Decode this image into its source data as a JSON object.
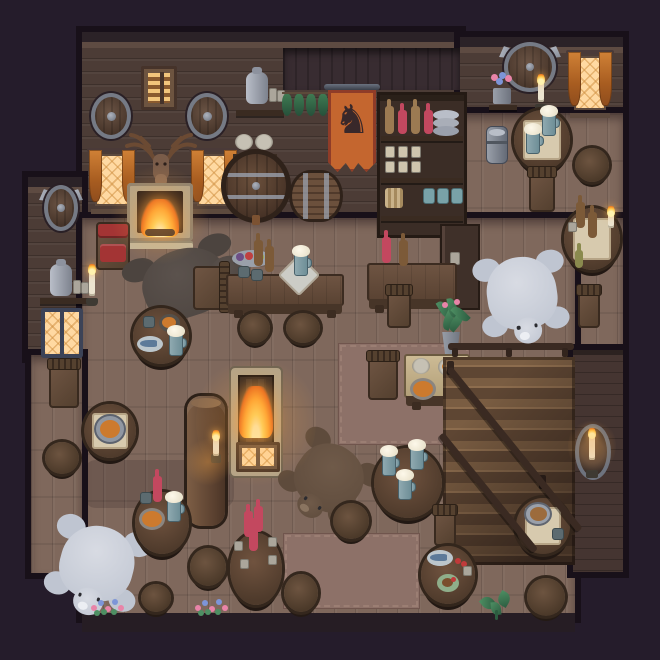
{
  "meta": {
    "app": "Pixel-art tavern interior — top-down game scene",
    "canvas": {
      "w": 660,
      "h": 660
    }
  },
  "palette": {
    "outside": "#251c2b",
    "frame": "#181019",
    "wallBase": "#4c3c36",
    "wallHeader": "#2b2227",
    "wallTrim": "#5e4b42",
    "wallRecess": "#382c31",
    "wallLow": "#453531",
    "floorBase": "#7f685c",
    "band": "#261d24",
    "carpet": "#8d7168",
    "carpetBorder": "#a3867a",
    "stone": "#b3a489",
    "cloth": "#d7caae",
    "windowGlow": "#ffd9a2",
    "fire1": "#ffe08a",
    "fire2": "#ffae34",
    "fire3": "#e25c1e",
    "bottleRed": "#c3485f",
    "bottleBrown": "#7c5a38",
    "bottleTan": "#9c7a52",
    "mugTeal": "#7fa0a8",
    "foam": "#f3ecd9",
    "polar": "#d8dbe3",
    "polarShade": "#bfc5d1",
    "rugBrown": "#6f5a49",
    "rugDark": "#5b524d",
    "plant": "#3c7a55",
    "flowerPink": "#e884a8",
    "flowerBlue": "#7d95d8",
    "soup": "#cc7a2e",
    "cushion": "#a33434",
    "banner": "#c4662f",
    "bannerTrim": "#8f3c28",
    "horse": "#39282a",
    "metal": "#9aa0ac"
  },
  "structure": [
    {
      "n": "wall-main",
      "k": "wall",
      "x": 82,
      "y": 32,
      "w": 378,
      "h": 188
    },
    {
      "n": "wall-right",
      "k": "wall",
      "x": 460,
      "y": 37,
      "w": 163,
      "h": 78
    },
    {
      "n": "wall-annex-left",
      "k": "wall",
      "x": 28,
      "y": 177,
      "w": 54,
      "h": 180
    },
    {
      "n": "wall-recess-center",
      "k": "wall-recess",
      "x": 283,
      "y": 48,
      "w": 177,
      "h": 42
    },
    {
      "n": "floor-right-upper",
      "k": "floor",
      "x": 460,
      "y": 113,
      "w": 163,
      "h": 107
    },
    {
      "n": "floor-right-mid",
      "k": "floor",
      "x": 575,
      "y": 218,
      "w": 48,
      "h": 132
    },
    {
      "n": "floor-main",
      "k": "floor",
      "x": 82,
      "y": 218,
      "w": 493,
      "h": 399
    },
    {
      "n": "floor-annex-left",
      "k": "floor",
      "x": 31,
      "y": 355,
      "w": 51,
      "h": 218
    },
    {
      "n": "wall-stairwell-right",
      "k": "wall-low",
      "x": 573,
      "y": 350,
      "w": 50,
      "h": 222
    },
    {
      "n": "baseboard-bottom",
      "k": "band",
      "x": 82,
      "y": 613,
      "w": 493,
      "h": 19
    },
    {
      "n": "carpet-center",
      "k": "carpet",
      "x": 338,
      "y": 343,
      "w": 132,
      "h": 102
    },
    {
      "n": "carpet-bottom",
      "k": "carpet",
      "x": 283,
      "y": 533,
      "w": 137,
      "h": 76
    },
    {
      "n": "floor-shadow-left",
      "k": "shadow",
      "x": 84,
      "y": 460,
      "w": 150,
      "h": 48
    }
  ],
  "objects": [
    {
      "n": "shuttered-window",
      "k": "win-shutter",
      "x": 141,
      "y": 66,
      "w": 36,
      "h": 44,
      "i": false
    },
    {
      "n": "round-shield-left",
      "k": "shield",
      "x": 91,
      "y": 93,
      "w": 40,
      "h": 46,
      "i": false
    },
    {
      "n": "round-shield-right",
      "k": "shield",
      "x": 187,
      "y": 93,
      "w": 40,
      "h": 46,
      "i": false
    },
    {
      "n": "stag-trophy",
      "k": "stag",
      "x": 121,
      "y": 130,
      "w": 80,
      "h": 62,
      "i": false
    },
    {
      "n": "curtain-window-left",
      "k": "win-curtain",
      "x": 87,
      "y": 148,
      "w": 50,
      "h": 66,
      "i": false
    },
    {
      "n": "curtain-window-right",
      "k": "win-curtain",
      "x": 189,
      "y": 148,
      "w": 50,
      "h": 66,
      "i": false
    },
    {
      "n": "stone-fireplace",
      "k": "fireplace",
      "x": 127,
      "y": 183,
      "w": 66,
      "h": 66,
      "i": true
    },
    {
      "n": "jug-shelf-center",
      "k": "jugshelf",
      "x": 236,
      "y": 70,
      "w": 48,
      "h": 46,
      "i": false
    },
    {
      "n": "hanging-herbs",
      "k": "herbs",
      "x": 282,
      "y": 92,
      "w": 48,
      "h": 30,
      "i": false
    },
    {
      "n": "horse-banner",
      "k": "banner",
      "x": 324,
      "y": 84,
      "w": 56,
      "h": 88,
      "i": false
    },
    {
      "n": "plate-shelf",
      "k": "plateshelf",
      "x": 233,
      "y": 134,
      "w": 44,
      "h": 26,
      "i": false
    },
    {
      "n": "basket-shelf",
      "k": "basketshelf",
      "x": 232,
      "y": 170,
      "w": 50,
      "h": 40,
      "i": false
    },
    {
      "n": "barrel-front",
      "k": "barrel-face",
      "x": 221,
      "y": 149,
      "w": 70,
      "h": 74,
      "i": true
    },
    {
      "n": "barrel-side",
      "k": "barrel-side",
      "x": 289,
      "y": 170,
      "w": 54,
      "h": 52,
      "i": true
    },
    {
      "n": "bottle-shelf-unit",
      "k": "shelfunit",
      "x": 377,
      "y": 92,
      "w": 90,
      "h": 146,
      "i": true,
      "p": {
        "top": [
          "tan",
          "red",
          "tan",
          "red"
        ],
        "cups": 6,
        "tealMugs": 3
      }
    },
    {
      "n": "side-counter",
      "k": "counter",
      "x": 440,
      "y": 224,
      "w": 40,
      "h": 86,
      "i": true
    },
    {
      "n": "axe-shield-large",
      "k": "shield-axe",
      "x": 498,
      "y": 40,
      "w": 64,
      "h": 54,
      "i": false
    },
    {
      "n": "flower-pot-shelf",
      "k": "flowershelf",
      "x": 489,
      "y": 72,
      "w": 28,
      "h": 38,
      "i": false
    },
    {
      "n": "candle-sconce-upper",
      "k": "sconce",
      "x": 533,
      "y": 76,
      "w": 16,
      "h": 36,
      "i": false
    },
    {
      "n": "curtain-window-upper-right",
      "k": "win-curtain",
      "x": 566,
      "y": 50,
      "w": 48,
      "h": 68,
      "i": false
    },
    {
      "n": "axe-shield-annex",
      "k": "shield-axe",
      "x": 38,
      "y": 183,
      "w": 46,
      "h": 50,
      "i": false
    },
    {
      "n": "jug-shelf-annex",
      "k": "jugshelf",
      "x": 40,
      "y": 262,
      "w": 50,
      "h": 42,
      "i": false
    },
    {
      "n": "candle-sconce-annex",
      "k": "sconce",
      "x": 84,
      "y": 266,
      "w": 16,
      "h": 40,
      "i": false
    },
    {
      "n": "side-window-annex",
      "k": "win-side",
      "x": 41,
      "y": 308,
      "w": 42,
      "h": 50,
      "i": false
    },
    {
      "n": "cushioned-chair",
      "k": "chair-red",
      "x": 94,
      "y": 220,
      "w": 38,
      "h": 52,
      "i": true
    },
    {
      "n": "rug-darkbear",
      "k": "rug-bear",
      "x": 128,
      "y": 240,
      "w": 114,
      "h": 88,
      "i": false,
      "p": {
        "tone": "dark",
        "rot": -18,
        "head": "right"
      }
    },
    {
      "n": "chair-by-rug",
      "k": "chair",
      "x": 190,
      "y": 260,
      "w": 40,
      "h": 54,
      "i": true,
      "p": {
        "dir": "right"
      }
    },
    {
      "n": "table-fish-west",
      "k": "table-round",
      "x": 133,
      "y": 308,
      "w": 56,
      "h": 56,
      "i": true,
      "p": {
        "items": [
          {
            "t": "mug",
            "x": 10,
            "y": 8
          },
          {
            "t": "pie",
            "x": 26,
            "y": 6
          },
          {
            "t": "fishplate",
            "x": 4,
            "y": 28
          },
          {
            "t": "stein",
            "x": 36,
            "y": 24
          }
        ]
      }
    },
    {
      "n": "chair-annex",
      "k": "chair",
      "x": 46,
      "y": 358,
      "w": 36,
      "h": 54,
      "i": true,
      "p": {
        "dir": "up"
      }
    },
    {
      "n": "table-cauldron",
      "k": "table-round",
      "x": 84,
      "y": 404,
      "w": 52,
      "h": 54,
      "i": true,
      "p": {
        "cloth": true,
        "items": [
          {
            "t": "cauldron",
            "x": 10,
            "y": 10
          }
        ]
      }
    },
    {
      "n": "stool-annex",
      "k": "stool",
      "x": 45,
      "y": 442,
      "w": 34,
      "h": 32,
      "i": true
    },
    {
      "n": "roof-beam-pillar",
      "k": "pillar",
      "x": 187,
      "y": 396,
      "w": 38,
      "h": 130,
      "i": false
    },
    {
      "n": "rug-polarbear-southwest",
      "k": "rug-bear",
      "x": 48,
      "y": 516,
      "w": 98,
      "h": 96,
      "i": false,
      "p": {
        "tone": "polar",
        "rot": 15,
        "head": "down"
      }
    },
    {
      "n": "table-stew-southwest",
      "k": "table-round",
      "x": 135,
      "y": 492,
      "w": 54,
      "h": 62,
      "i": true,
      "p": {
        "items": [
          {
            "t": "bottle",
            "c": "red",
            "x": 18,
            "y": -16
          },
          {
            "t": "mug",
            "x": 5,
            "y": 0
          },
          {
            "t": "bowl",
            "x": 4,
            "y": 16
          },
          {
            "t": "stein",
            "x": 32,
            "y": 6
          }
        ]
      }
    },
    {
      "n": "stool-sw-1",
      "k": "stool",
      "x": 190,
      "y": 548,
      "w": 36,
      "h": 38,
      "i": true
    },
    {
      "n": "stool-sw-2",
      "k": "stool",
      "x": 141,
      "y": 584,
      "w": 30,
      "h": 28,
      "i": true
    },
    {
      "n": "flowerbed-left",
      "k": "flowers",
      "x": 91,
      "y": 597,
      "w": 36,
      "h": 18,
      "i": false
    },
    {
      "n": "flowerbed-mid",
      "k": "flowers",
      "x": 195,
      "y": 597,
      "w": 30,
      "h": 18,
      "i": false
    },
    {
      "n": "bar-table",
      "k": "table-rect",
      "x": 226,
      "y": 274,
      "w": 118,
      "h": 44,
      "i": true,
      "p": {
        "items": [
          {
            "t": "fruitbowl",
            "x": 6,
            "y": -24
          },
          {
            "t": "bottle",
            "c": "brown",
            "x": 28,
            "y": -34
          },
          {
            "t": "bottle",
            "c": "brown",
            "x": 39,
            "y": -28
          },
          {
            "t": "mug",
            "x": 12,
            "y": -8
          },
          {
            "t": "mug",
            "x": 25,
            "y": -5
          },
          {
            "t": "napkin",
            "x": 58,
            "y": -14
          },
          {
            "t": "stein",
            "x": 68,
            "y": -22
          }
        ]
      }
    },
    {
      "n": "stool-bar-1",
      "k": "stool",
      "x": 240,
      "y": 313,
      "w": 30,
      "h": 30,
      "i": true
    },
    {
      "n": "stool-bar-2",
      "k": "stool",
      "x": 286,
      "y": 313,
      "w": 34,
      "h": 30,
      "i": true
    },
    {
      "n": "table-bottles",
      "k": "table-rect",
      "x": 367,
      "y": 263,
      "w": 90,
      "h": 50,
      "i": true,
      "p": {
        "items": [
          {
            "t": "bottle",
            "c": "red",
            "x": 15,
            "y": -26
          },
          {
            "t": "bottle",
            "c": "brown",
            "x": 32,
            "y": -23
          }
        ]
      }
    },
    {
      "n": "chair-bottles",
      "k": "chair",
      "x": 384,
      "y": 284,
      "w": 30,
      "h": 48,
      "i": true,
      "p": {
        "dir": "up"
      }
    },
    {
      "n": "floor-firepit",
      "k": "firepit",
      "x": 231,
      "y": 368,
      "w": 50,
      "h": 108,
      "i": true
    },
    {
      "n": "cellar-hatch",
      "k": "hatch",
      "x": 236,
      "y": 442,
      "w": 44,
      "h": 30,
      "i": true
    },
    {
      "n": "rug-brownbear",
      "k": "rug-bear",
      "x": 284,
      "y": 436,
      "w": 90,
      "h": 84,
      "i": false,
      "p": {
        "tone": "brown",
        "rot": 35,
        "head": "down"
      }
    },
    {
      "n": "plant-pot-tall",
      "k": "plant-tall",
      "x": 434,
      "y": 298,
      "w": 34,
      "h": 56,
      "i": false
    },
    {
      "n": "table-supper",
      "k": "table-rect",
      "x": 404,
      "y": 354,
      "w": 66,
      "h": 56,
      "i": true,
      "p": {
        "light": true,
        "items": [
          {
            "t": "plate",
            "x": 8,
            "y": 4
          },
          {
            "t": "toastplate",
            "x": 34,
            "y": 4
          },
          {
            "t": "bowl",
            "x": 6,
            "y": 24
          },
          {
            "t": "candle",
            "x": 54,
            "y": 26
          }
        ]
      }
    },
    {
      "n": "chair-supper",
      "k": "chair",
      "x": 365,
      "y": 350,
      "w": 36,
      "h": 54,
      "i": true,
      "p": {
        "dir": "up"
      }
    },
    {
      "n": "railing-landing",
      "k": "railing",
      "x": 448,
      "y": 343,
      "w": 126,
      "h": 14,
      "i": false
    },
    {
      "n": "staircase-down",
      "k": "stairs",
      "x": 443,
      "y": 357,
      "w": 132,
      "h": 208,
      "i": true
    },
    {
      "n": "candle-shield-stairwell",
      "k": "sconce-shield",
      "x": 571,
      "y": 424,
      "w": 44,
      "h": 56,
      "i": false
    },
    {
      "n": "rug-polarbear-east",
      "k": "rug-bear",
      "x": 476,
      "y": 248,
      "w": 92,
      "h": 92,
      "i": false,
      "p": {
        "tone": "polar",
        "rot": -8,
        "head": "down"
      }
    },
    {
      "n": "table-trio-steins",
      "k": "table-round",
      "x": 374,
      "y": 448,
      "w": 68,
      "h": 70,
      "i": true,
      "p": {
        "items": [
          {
            "t": "stein",
            "x": 8,
            "y": 4
          },
          {
            "t": "stein",
            "x": 36,
            "y": -2
          },
          {
            "t": "stein",
            "x": 24,
            "y": 28
          }
        ]
      }
    },
    {
      "n": "stool-center",
      "k": "stool",
      "x": 333,
      "y": 503,
      "w": 36,
      "h": 36,
      "i": true
    },
    {
      "n": "table-wine",
      "k": "table-round",
      "x": 230,
      "y": 533,
      "w": 52,
      "h": 72,
      "i": true,
      "p": {
        "items": [
          {
            "t": "bottle",
            "c": "red",
            "x": 14,
            "y": -22
          },
          {
            "t": "bottle",
            "c": "red",
            "x": 24,
            "y": -27
          },
          {
            "t": "bottle",
            "c": "red",
            "x": 19,
            "y": -8
          },
          {
            "t": "cup",
            "x": 4,
            "y": 8
          },
          {
            "t": "cup",
            "x": 38,
            "y": 4
          },
          {
            "t": "cup",
            "x": 10,
            "y": 26
          },
          {
            "t": "cup",
            "x": 38,
            "y": 22
          }
        ]
      }
    },
    {
      "n": "stool-south",
      "k": "stool",
      "x": 284,
      "y": 574,
      "w": 34,
      "h": 38,
      "i": true
    },
    {
      "n": "plant-sprout",
      "k": "plant-sprout",
      "x": 480,
      "y": 590,
      "w": 34,
      "h": 30,
      "i": false
    },
    {
      "n": "milk-can",
      "k": "can",
      "x": 486,
      "y": 126,
      "w": 22,
      "h": 38,
      "i": true
    },
    {
      "n": "table-ne",
      "k": "table-round",
      "x": 514,
      "y": 110,
      "w": 56,
      "h": 60,
      "i": true,
      "p": {
        "cloth": true,
        "items": [
          {
            "t": "stein",
            "x": 28,
            "y": 2
          },
          {
            "t": "stein",
            "x": 12,
            "y": 20
          }
        ]
      }
    },
    {
      "n": "chair-ne",
      "k": "chair",
      "x": 526,
      "y": 166,
      "w": 32,
      "h": 50,
      "i": true,
      "p": {
        "dir": "up"
      }
    },
    {
      "n": "stool-ne",
      "k": "stool",
      "x": 575,
      "y": 148,
      "w": 34,
      "h": 34,
      "i": true
    },
    {
      "n": "table-candlelit",
      "k": "table-round",
      "x": 564,
      "y": 208,
      "w": 56,
      "h": 62,
      "i": true,
      "p": {
        "cloth": true,
        "items": [
          {
            "t": "bottle",
            "c": "brown",
            "x": 12,
            "y": -6
          },
          {
            "t": "bottle",
            "c": "brown",
            "x": 24,
            "y": 4
          },
          {
            "t": "cup",
            "x": 4,
            "y": 14
          },
          {
            "t": "candle",
            "x": 44,
            "y": 6
          }
        ]
      }
    },
    {
      "n": "chair-east",
      "k": "chair",
      "x": 575,
      "y": 284,
      "w": 28,
      "h": 48,
      "i": true,
      "p": {
        "dir": "up"
      }
    },
    {
      "n": "bottle-on-floor",
      "k": "minibottle",
      "x": 575,
      "y": 250,
      "w": 8,
      "h": 18,
      "i": false
    },
    {
      "n": "chair-fishtable",
      "k": "chair",
      "x": 431,
      "y": 504,
      "w": 28,
      "h": 46,
      "i": true,
      "p": {
        "dir": "up"
      }
    },
    {
      "n": "table-fish-south",
      "k": "table-round",
      "x": 421,
      "y": 546,
      "w": 54,
      "h": 58,
      "i": true,
      "p": {
        "items": [
          {
            "t": "fishplate",
            "x": 6,
            "y": 4
          },
          {
            "t": "tomato",
            "x": 34,
            "y": 12
          },
          {
            "t": "meatplate",
            "x": 16,
            "y": 28
          },
          {
            "t": "cup",
            "x": 42,
            "y": 20
          }
        ]
      }
    },
    {
      "n": "table-bread",
      "k": "table-round",
      "x": 516,
      "y": 498,
      "w": 54,
      "h": 56,
      "i": true,
      "p": {
        "cloth": true,
        "items": [
          {
            "t": "breadpot",
            "x": 8,
            "y": 4
          },
          {
            "t": "mug",
            "x": 36,
            "y": 30
          }
        ]
      }
    },
    {
      "n": "stool-se",
      "k": "stool",
      "x": 527,
      "y": 578,
      "w": 38,
      "h": 38,
      "i": true
    },
    {
      "n": "glow-fireplace",
      "k": "glow",
      "x": 110,
      "y": 165,
      "w": 100,
      "h": 100,
      "i": false
    },
    {
      "n": "glow-firepit",
      "k": "glow",
      "x": 196,
      "y": 352,
      "w": 120,
      "h": 140,
      "i": false
    },
    {
      "n": "glow-pillar-torch",
      "k": "glow",
      "x": 184,
      "y": 438,
      "w": 48,
      "h": 48,
      "i": false
    },
    {
      "n": "glow-stairwell",
      "k": "glow",
      "x": 568,
      "y": 418,
      "w": 48,
      "h": 56,
      "i": false
    }
  ]
}
